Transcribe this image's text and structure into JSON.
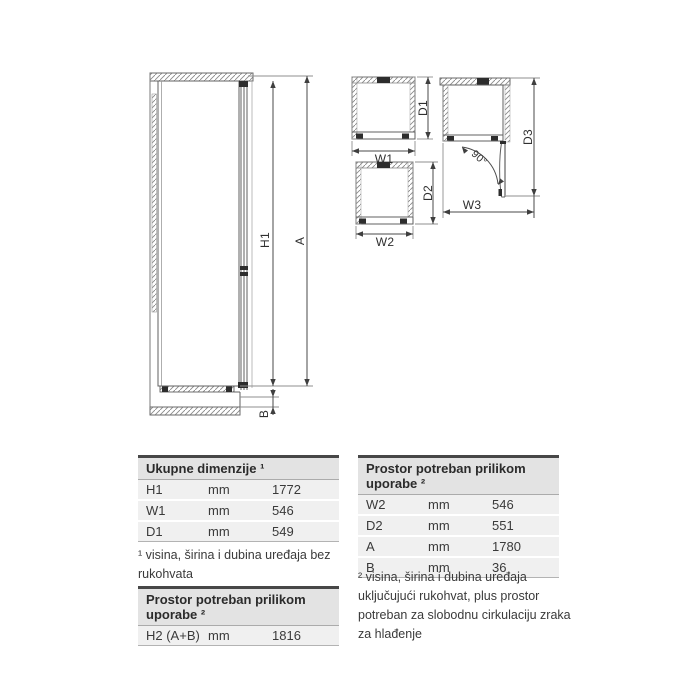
{
  "diagram": {
    "labels": {
      "h1": "H1",
      "a": "A",
      "b": "B",
      "w1": "W1",
      "d1": "D1",
      "w2": "W2",
      "d2": "D2",
      "w3": "W3",
      "d3": "D3",
      "angle": "90°"
    }
  },
  "tables": {
    "overall": {
      "title": "Ukupne dimenzije ¹",
      "rows": [
        {
          "label": "H1",
          "unit": "mm",
          "value": "1772"
        },
        {
          "label": "W1",
          "unit": "mm",
          "value": "546"
        },
        {
          "label": "D1",
          "unit": "mm",
          "value": "549"
        }
      ],
      "footnote": "¹ visina, širina i dubina uređaja bez rukohvata"
    },
    "usage_left": {
      "title": "Prostor potreban prilikom uporabe ²",
      "rows": [
        {
          "label": "H2 (A+B)",
          "unit": "mm",
          "value": "1816"
        }
      ]
    },
    "usage_right": {
      "title": "Prostor potreban prilikom uporabe ²",
      "rows": [
        {
          "label": "W2",
          "unit": "mm",
          "value": "546"
        },
        {
          "label": "D2",
          "unit": "mm",
          "value": "551"
        },
        {
          "label": "A",
          "unit": "mm",
          "value": "1780"
        },
        {
          "label": "B",
          "unit": "mm",
          "value": "36"
        }
      ],
      "footnote": "² visina, širina i dubina uređaja uključujući rukohvat, plus prostor potreban za slobodnu cirkulaciju zraka za hlađenje"
    }
  },
  "colors": {
    "background": "#ffffff",
    "outline": "#606060",
    "dimension": "#4a4a4a",
    "extension": "#8f8f8f",
    "header_bg": "#e3e3e3",
    "row_bg": "#f0f0f0",
    "header_top_border": "#474747",
    "text": "#3a3a3a"
  }
}
